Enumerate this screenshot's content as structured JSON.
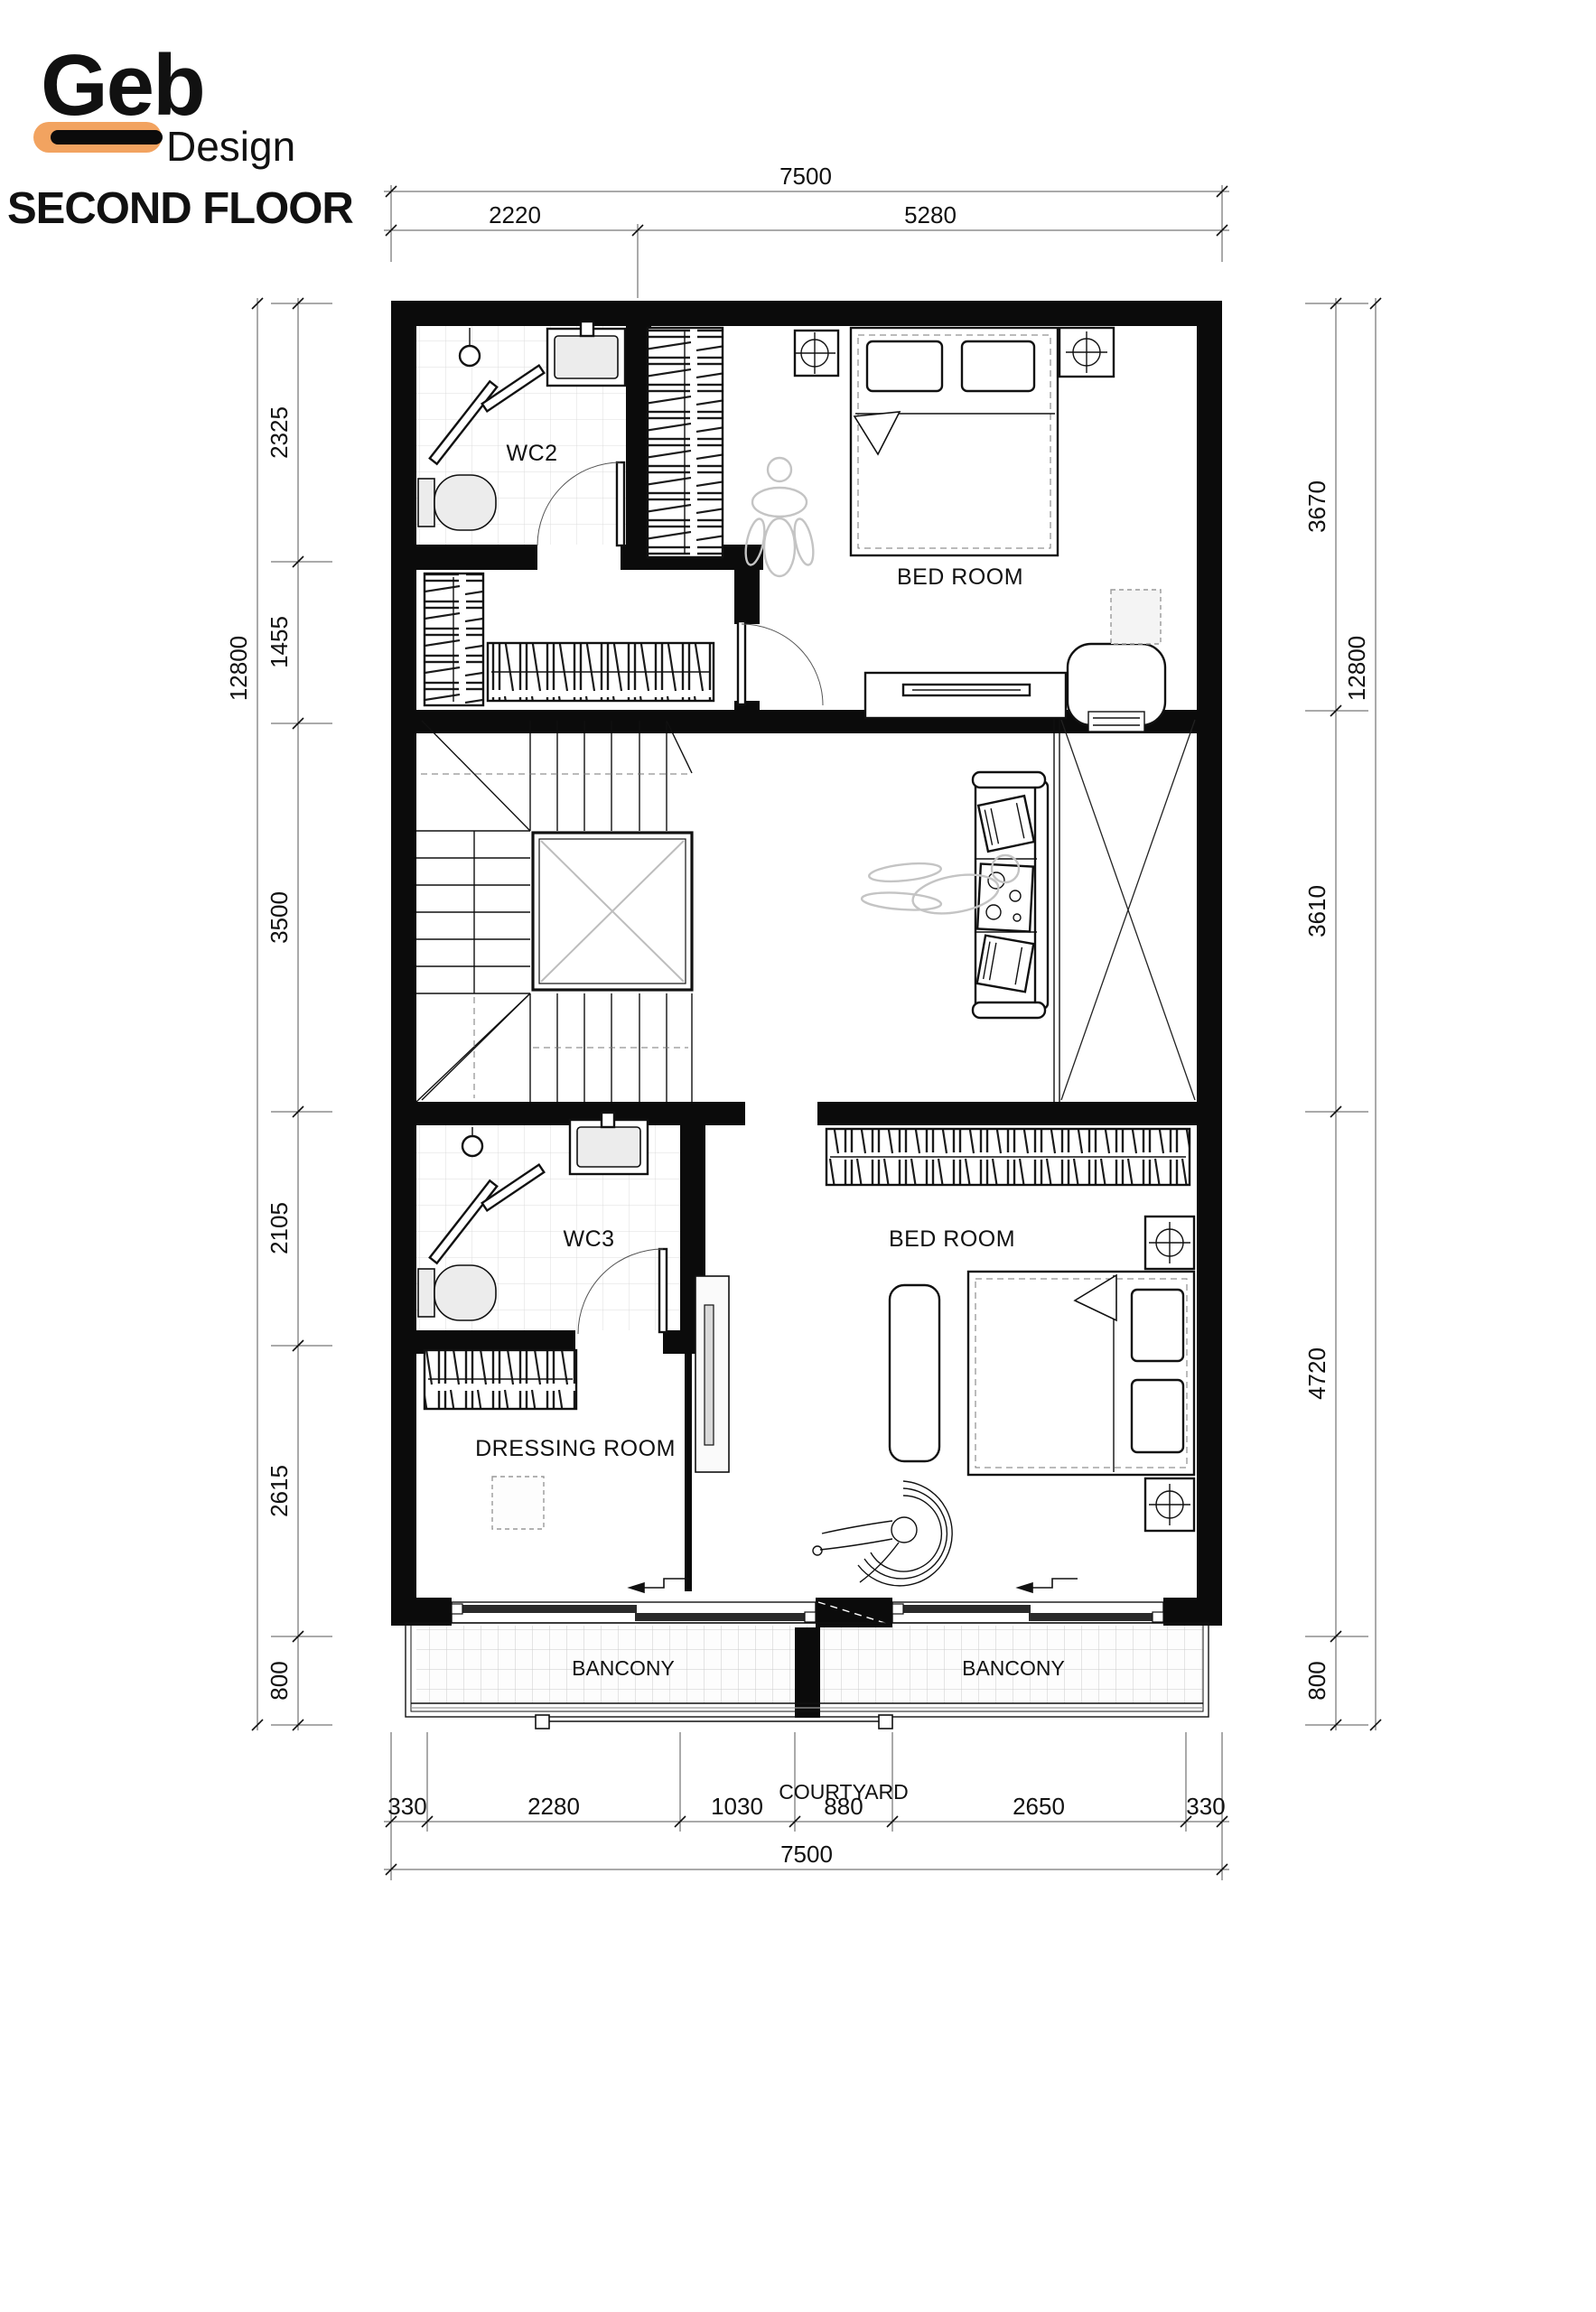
{
  "brand": {
    "logo_top": "Geb",
    "logo_sub": "Design",
    "accent": "#F2A360"
  },
  "title": "SECOND FLOOR",
  "rooms": {
    "wc2": "WC2",
    "bedroom_top": "BED ROOM",
    "wc3": "WC3",
    "bedroom_bottom": "BED ROOM",
    "dressing": "DRESSING ROOM",
    "balcony_left": "BANCONY",
    "balcony_right": "BANCONY",
    "courtyard": "COURTYARD"
  },
  "dimensions": {
    "top": {
      "total": "7500",
      "segments": [
        "2220",
        "5280"
      ]
    },
    "bottom": {
      "total": "7500",
      "segments": [
        "330",
        "2280",
        "1030",
        "880",
        "2650",
        "330"
      ]
    },
    "left": {
      "total": "12800",
      "segments": [
        "2325",
        "1455",
        "3500",
        "2105",
        "2615",
        "800"
      ]
    },
    "right": {
      "total": "12800",
      "segments": [
        "3670",
        "3610",
        "4720",
        "800"
      ]
    }
  }
}
